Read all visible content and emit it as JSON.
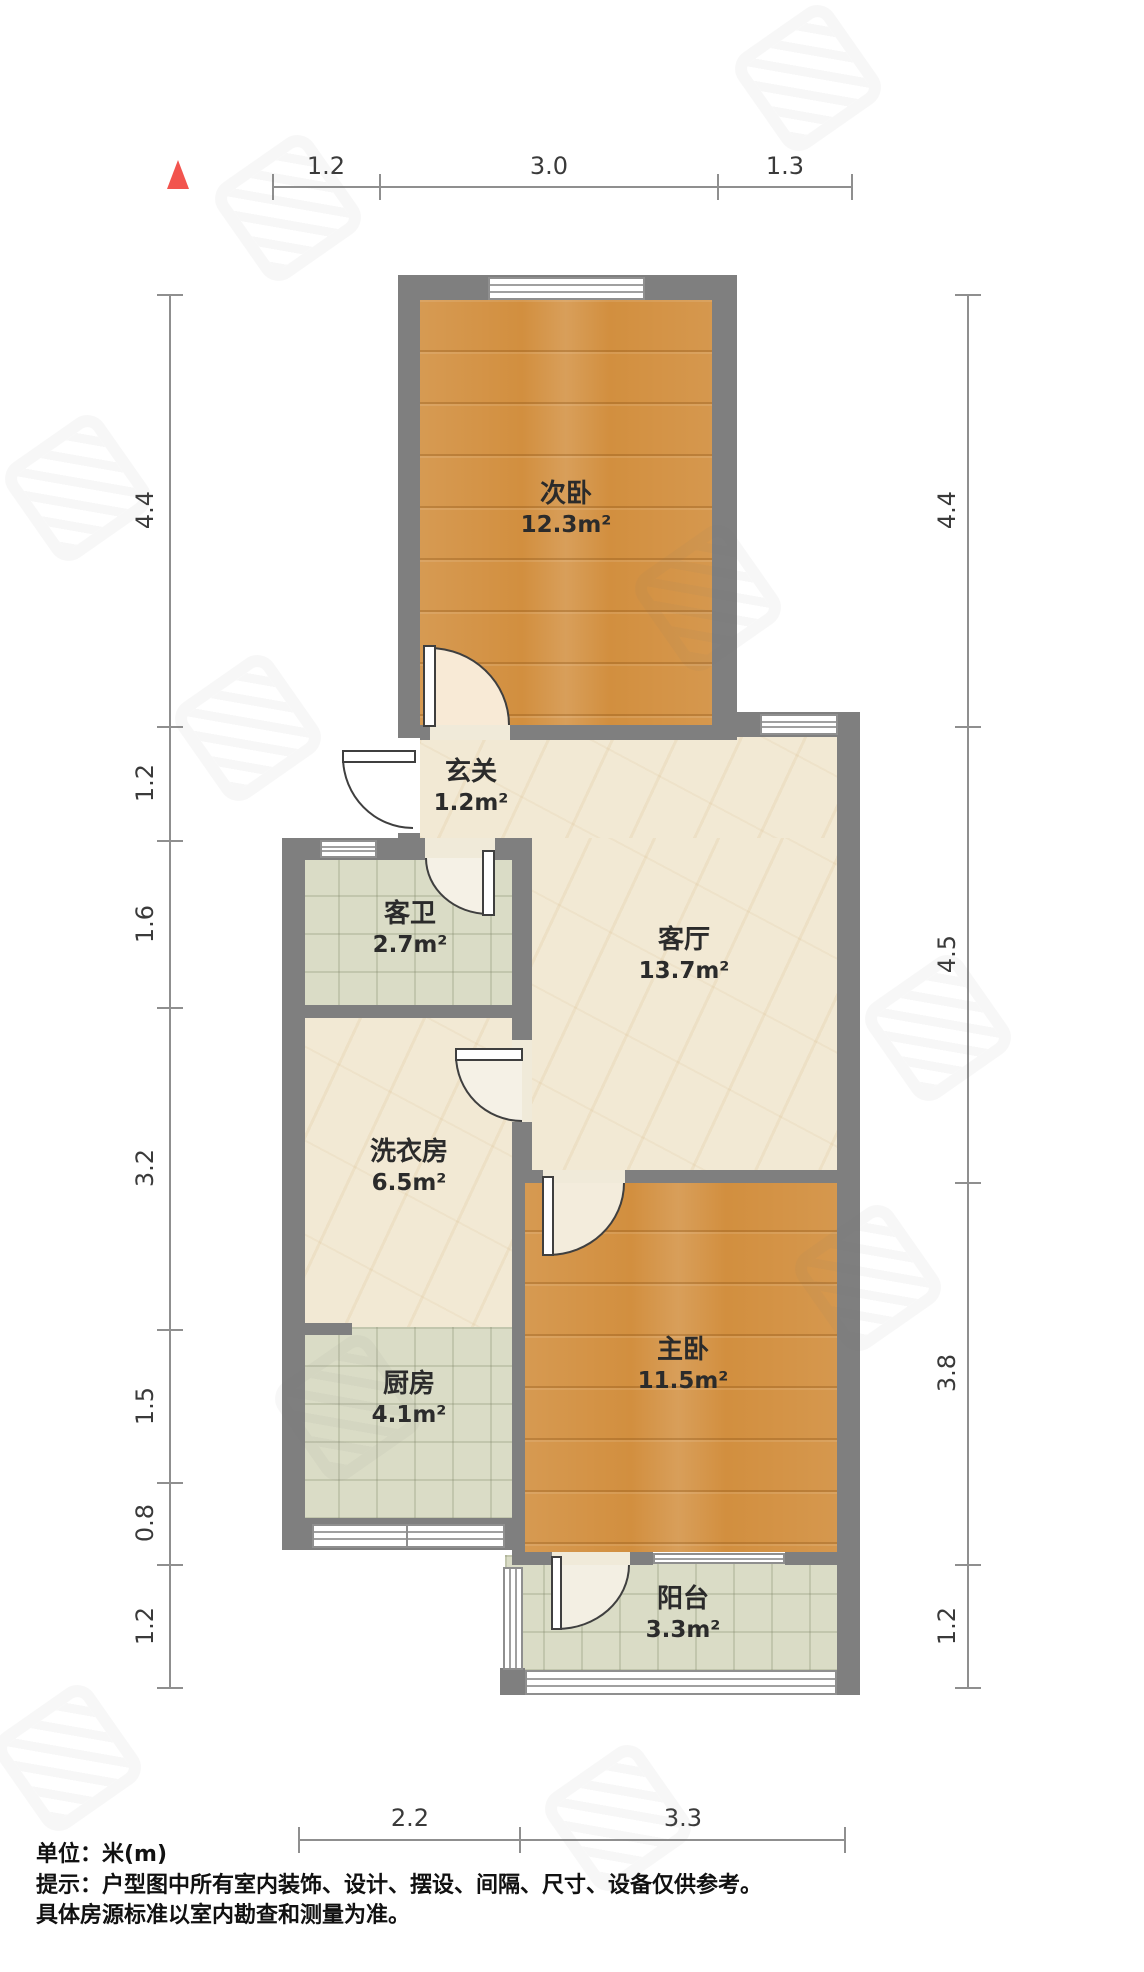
{
  "dims": {
    "top": [
      "1.2",
      "3.0",
      "1.3"
    ],
    "left": [
      "4.4",
      "1.2",
      "1.6",
      "3.2",
      "1.5",
      "0.8",
      "1.2"
    ],
    "right": [
      "4.4",
      "4.5",
      "3.8",
      "1.2"
    ],
    "bottom": [
      "2.2",
      "3.3"
    ]
  },
  "rooms": [
    {
      "name": "次卧",
      "area": "12.3m²"
    },
    {
      "name": "玄关",
      "area": "1.2m²"
    },
    {
      "name": "客卫",
      "area": "2.7m²"
    },
    {
      "name": "客厅",
      "area": "13.7m²"
    },
    {
      "name": "洗衣房",
      "area": "6.5m²"
    },
    {
      "name": "主卧",
      "area": "11.5m²"
    },
    {
      "name": "厨房",
      "area": "4.1m²"
    },
    {
      "name": "阳台",
      "area": "3.3m²"
    }
  ],
  "footer": {
    "unit_line": "单位：米(m)",
    "tip_line1": "提示：户型图中所有室内装饰、设计、摆设、间隔、尺寸、设备仅供参考。",
    "tip_line2": "具体房源标准以室内勘查和测量为准。"
  },
  "colors": {
    "wall": "#7f7f7f",
    "wood_floor": "#d28f3f",
    "marble_floor": "#f2e9d4",
    "tile_floor": "#dadcc6",
    "north_arrow": "#f2544e",
    "dim_line": "#8f8f8f"
  }
}
